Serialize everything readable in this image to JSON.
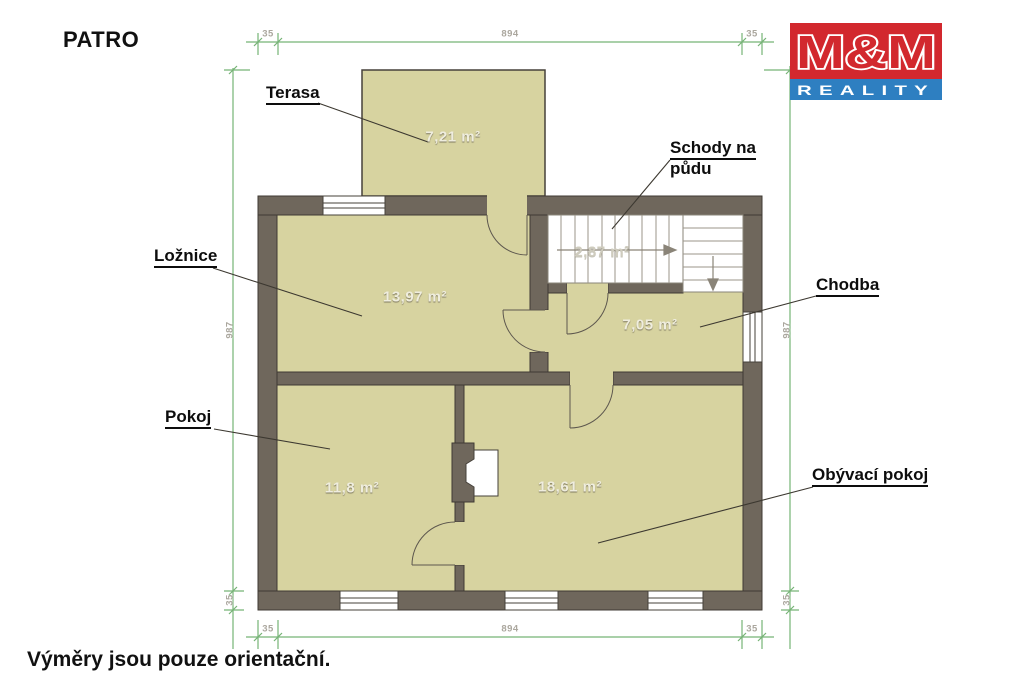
{
  "title": "PATRO",
  "footnote": "Výměry jsou pouze orientační.",
  "logo": {
    "top": "M&M",
    "bottom": "REALITY",
    "red": "#d2282e",
    "blue": "#2e7fc1"
  },
  "rooms": {
    "terasa": {
      "label": "Terasa",
      "area": "7,21 m²"
    },
    "loznice": {
      "label": "Ložnice",
      "area": "13,97 m²"
    },
    "schody": {
      "label": "Schody na půdu",
      "label_line1": "Schody na",
      "label_line2": "půdu",
      "area": "2,87 m²"
    },
    "chodba": {
      "label": "Chodba",
      "area": "7,05 m²"
    },
    "pokoj": {
      "label": "Pokoj",
      "area": "11,8 m²"
    },
    "obyvaci": {
      "label": "Obývací pokoj",
      "area": "18,61 m²"
    }
  },
  "dimensions": {
    "top_left_wall": "35",
    "top_width": "894",
    "top_right_wall": "35",
    "bottom_left_wall": "35",
    "bottom_width": "894",
    "bottom_right_wall": "35",
    "left_height": "987",
    "left_bottom_wall": "35",
    "right_height": "987",
    "right_bottom_wall": "35"
  },
  "colors": {
    "room_fill": "#d7d3a0",
    "wall": "#6f675c",
    "dimension_green": "#76b376"
  }
}
